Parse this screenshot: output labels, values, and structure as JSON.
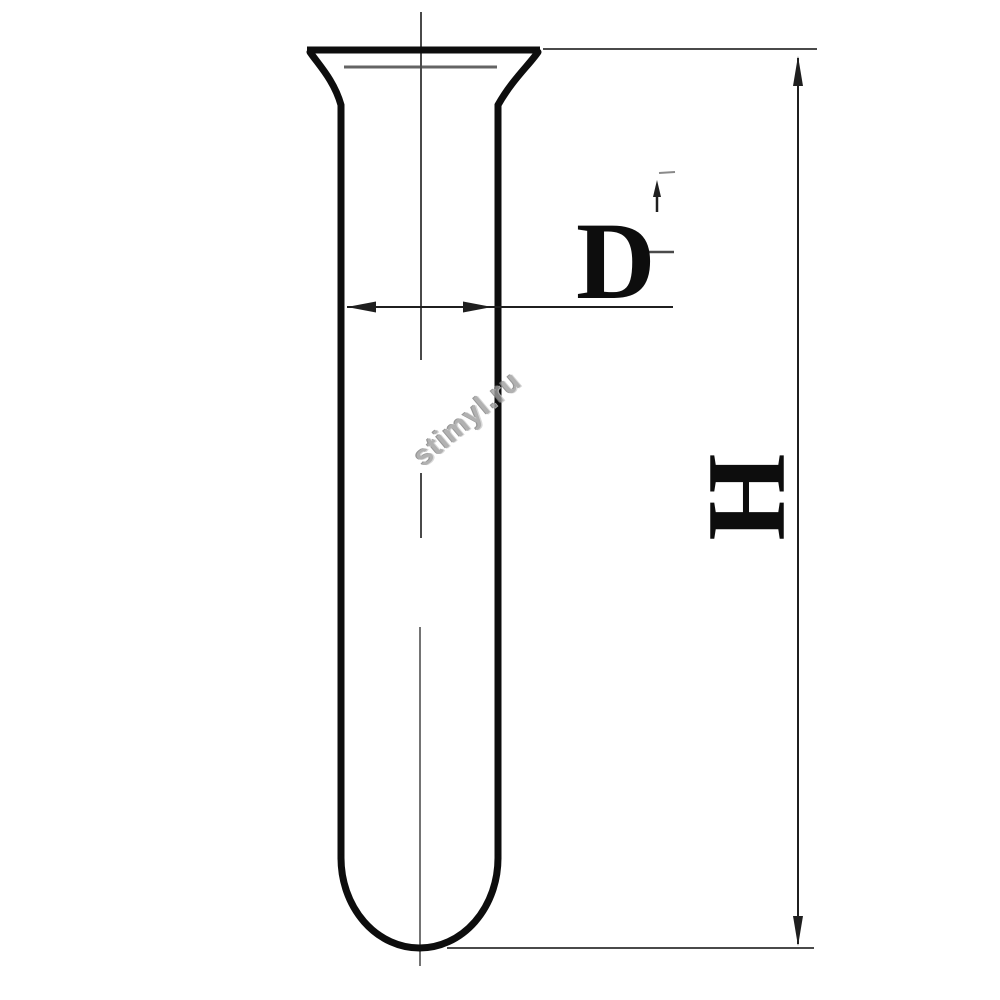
{
  "drawing": {
    "title": "test-tube-technical-drawing",
    "labels": {
      "diameter": "D",
      "height": "H"
    },
    "watermark": "stimyl.ru",
    "colors": {
      "outline": "#0d0d0d",
      "dimension": "#1f1f1f",
      "thin": "#4a4a4a",
      "faint": "#8a8a8a",
      "watermark": "#9e9e9e",
      "background": "#ffffff"
    }
  }
}
